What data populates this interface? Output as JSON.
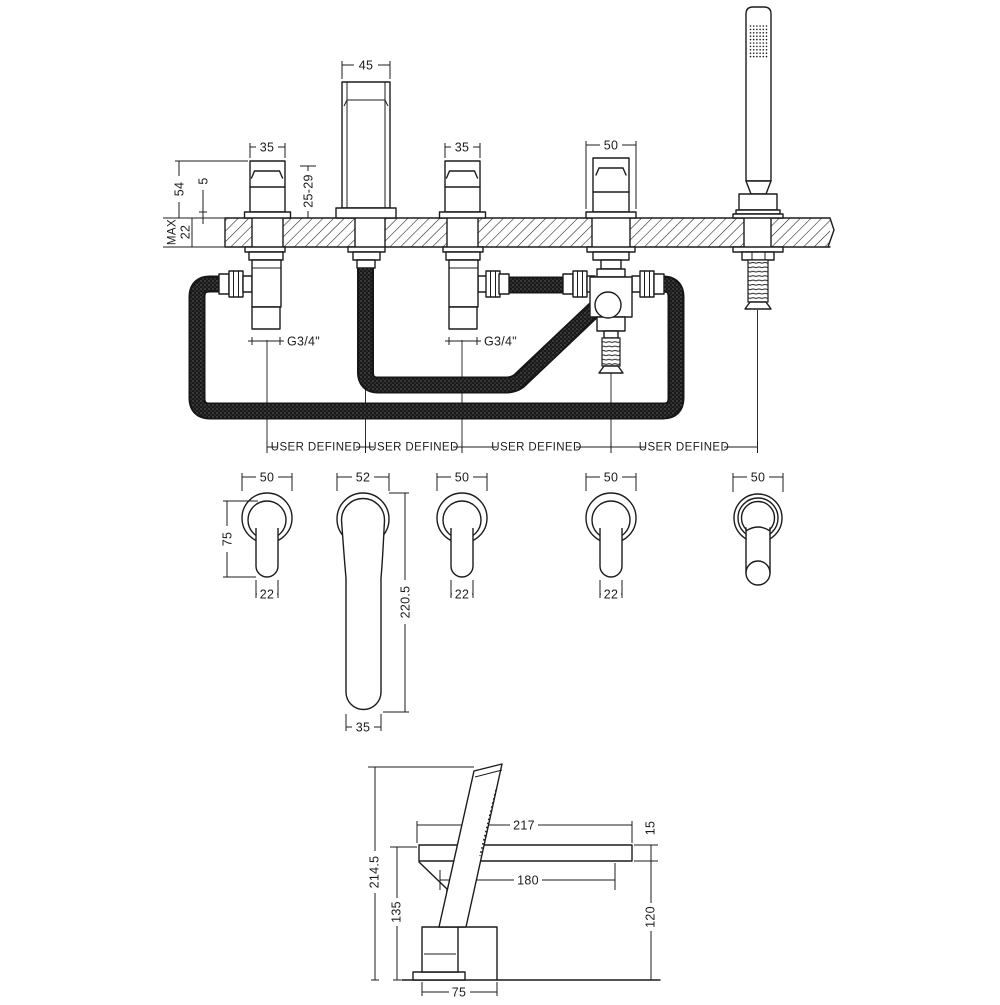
{
  "drawing_title": "bath-shower-mixer-technical-drawing",
  "colors": {
    "line": "#1c1c1c",
    "background": "#ffffff",
    "hose": "#161616"
  },
  "installation_view": {
    "spout_width": "45",
    "left_valve_width": "35",
    "right_valve_width": "35",
    "diverter_width": "50",
    "body_height": "54",
    "flange_height": "5",
    "deck_range": "25-29",
    "deck_max_label": "MAX",
    "deck_max_value": "22",
    "left_valve_thread": "G3/4\"",
    "right_valve_thread": "G3/4\"",
    "spacing_labels": [
      "USER DEFINED",
      "USER DEFINED",
      "USER DEFINED",
      "USER DEFINED"
    ]
  },
  "plan_view": {
    "handle_left": {
      "width": "50",
      "length": "75",
      "lever_width": "22"
    },
    "spout": {
      "width": "52",
      "length": "220.5",
      "tip_width": "35"
    },
    "handle_middle": {
      "width": "50",
      "lever_width": "22"
    },
    "handle_right": {
      "width": "50",
      "lever_width": "22"
    },
    "handset": {
      "width": "50"
    }
  },
  "side_view": {
    "spout_length": "217",
    "spout_thickness": "15",
    "spout_reach": "180",
    "total_height": "214.5",
    "spout_height": "135",
    "spout_clearance": "120",
    "body_depth": "75"
  }
}
